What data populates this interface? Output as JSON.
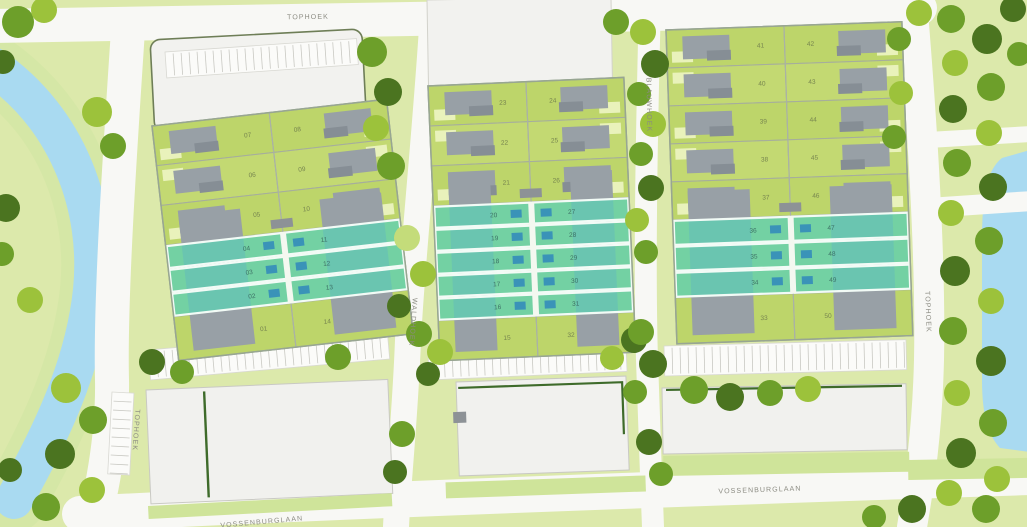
{
  "map_title": "residential-site-plan",
  "streets": {
    "tophoek_top": "TOPHOEK",
    "tophoek_left": "TOPHOEK",
    "waldhoek": "WALDHOEK",
    "blauwhoek": "BLAUWHOEK",
    "tophoek_right": "TOPHOEK",
    "vossenburglaan": "VOSSENBURGLAAN",
    "vossenburglaan_left": "VOSSENBURGLAAN"
  },
  "blocks": [
    {
      "id": "block-1",
      "rows": [
        {
          "left": "07",
          "right": "08",
          "type": "house",
          "highlighted": false
        },
        {
          "left": "06",
          "right": "09",
          "type": "house",
          "highlighted": false
        },
        {
          "left": "05",
          "right": "10",
          "type": "house",
          "highlighted": false
        },
        {
          "left": "04",
          "right": "11",
          "type": "strip",
          "highlighted": true
        },
        {
          "left": "03",
          "right": "12",
          "type": "strip",
          "highlighted": true
        },
        {
          "left": "02",
          "right": "13",
          "type": "strip",
          "highlighted": true
        },
        {
          "left": "01",
          "right": "14",
          "type": "bottom",
          "highlighted": false
        }
      ]
    },
    {
      "id": "block-2",
      "rows": [
        {
          "left": "23",
          "right": "24",
          "type": "house",
          "highlighted": false
        },
        {
          "left": "22",
          "right": "25",
          "type": "house",
          "highlighted": false
        },
        {
          "left": "21",
          "right": "26",
          "type": "house",
          "highlighted": false
        },
        {
          "left": "20",
          "right": "27",
          "type": "strip",
          "highlighted": true
        },
        {
          "left": "19",
          "right": "28",
          "type": "strip",
          "highlighted": true
        },
        {
          "left": "18",
          "right": "29",
          "type": "strip",
          "highlighted": true
        },
        {
          "left": "17",
          "right": "30",
          "type": "strip",
          "highlighted": true
        },
        {
          "left": "16",
          "right": "31",
          "type": "strip",
          "highlighted": true
        },
        {
          "left": "15",
          "right": "32",
          "type": "bottom",
          "highlighted": false
        }
      ]
    },
    {
      "id": "block-3",
      "rows": [
        {
          "left": "41",
          "right": "42",
          "type": "house",
          "highlighted": false
        },
        {
          "left": "40",
          "right": "43",
          "type": "house",
          "highlighted": false
        },
        {
          "left": "39",
          "right": "44",
          "type": "house",
          "highlighted": false
        },
        {
          "left": "38",
          "right": "45",
          "type": "house",
          "highlighted": false
        },
        {
          "left": "37",
          "right": "46",
          "type": "house",
          "highlighted": false
        },
        {
          "left": "36",
          "right": "47",
          "type": "strip",
          "highlighted": true
        },
        {
          "left": "35",
          "right": "48",
          "type": "strip",
          "highlighted": true
        },
        {
          "left": "34",
          "right": "49",
          "type": "strip",
          "highlighted": true
        },
        {
          "left": "33",
          "right": "50",
          "type": "bottom",
          "highlighted": false
        }
      ]
    }
  ],
  "colors": {
    "grass": "#dce9ab",
    "plot_green": "#bdd56a",
    "plot_green_alt": "#c8dd78",
    "patio": "#e9f2bb",
    "building_gray": "#98a0a6",
    "building_gray_dark": "#868e95",
    "teal_plot": "#5ecfb4",
    "teal_roof": "#3a93b8",
    "water": "#a9daf1",
    "street": "#f8f8f5",
    "white_building": "#f2f2ef",
    "hedge": "#3e6b2a",
    "tree_dark": "#4b7420",
    "tree_mid": "#6d9f2a",
    "tree_light": "#9cc23b",
    "tree_pale": "#c4dc7a"
  }
}
